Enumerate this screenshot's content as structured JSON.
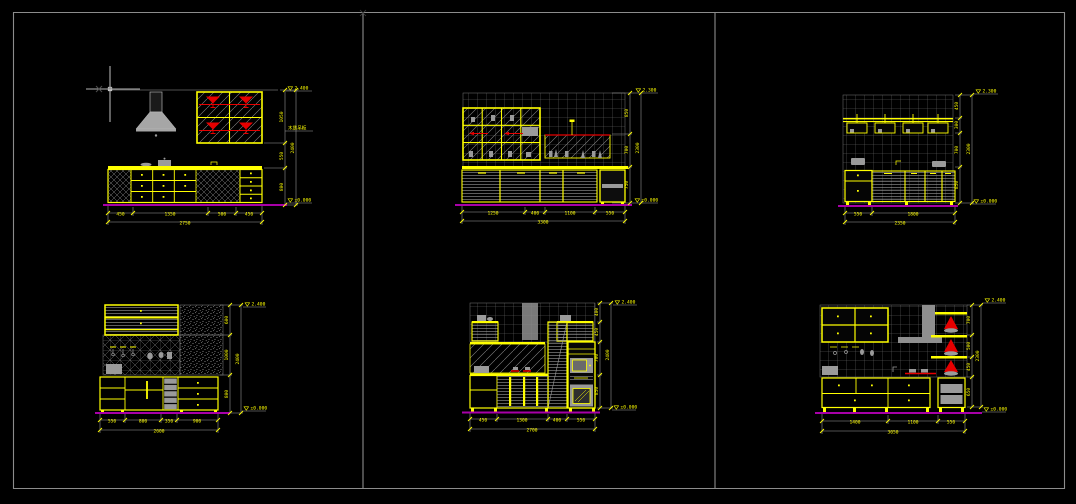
{
  "app": {
    "background": "#000000",
    "frame_color": "#8c8c8c",
    "accent_yellow": "#ffff00",
    "accent_red": "#e60000",
    "ground_color": "#a800a8",
    "grid_color": "#6d6d6d",
    "dim_color": "#a0a0a0",
    "cursor_color": "#f0f0f0"
  },
  "panels": [
    {
      "id": "kitchen-elevation-a",
      "h_dims": [
        "450",
        "1350",
        "500",
        "450"
      ],
      "h_total": "2750",
      "v_dims": [
        "1050",
        "550",
        "800"
      ],
      "v_total": "2400",
      "elev_top": "2.400",
      "elev_bottom": "±0.000",
      "note": "木质吊柜"
    },
    {
      "id": "kitchen-elevation-b",
      "h_dims": [
        "1250",
        "400",
        "1100",
        "550"
      ],
      "h_total": "3300",
      "v_dims": [
        "850",
        "700",
        "750"
      ],
      "v_total": "2300",
      "elev_top": "2.300",
      "elev_bottom": "±0.000"
    },
    {
      "id": "kitchen-elevation-c",
      "h_dims": [
        "550",
        "1800"
      ],
      "h_total": "2350",
      "v_dims": [
        "450",
        "300",
        "700",
        "850"
      ],
      "v_total": "2300",
      "elev_top": "2.300",
      "elev_bottom": "±0.000"
    },
    {
      "id": "kitchen-elevation-d",
      "h_dims": [
        "550",
        "800",
        "350",
        "900"
      ],
      "h_total": "2600",
      "v_dims": [
        "600",
        "1000",
        "800"
      ],
      "v_total": "2400",
      "elev_top": "2.400",
      "elev_bottom": "±0.000"
    },
    {
      "id": "kitchen-elevation-e",
      "h_dims": [
        "450",
        "1300",
        "400",
        "550"
      ],
      "h_total": "2700",
      "v_dims": [
        "400",
        "450",
        "700",
        "850"
      ],
      "v_total": "2400",
      "elev_top": "2.400",
      "elev_bottom": "±0.000"
    },
    {
      "id": "kitchen-elevation-f",
      "h_dims": [
        "1400",
        "1100",
        "550"
      ],
      "h_total": "3050",
      "v_dims": [
        "700",
        "500",
        "450",
        "650"
      ],
      "v_total": "2300",
      "elev_top": "2.400",
      "elev_bottom": "±0.000"
    }
  ]
}
